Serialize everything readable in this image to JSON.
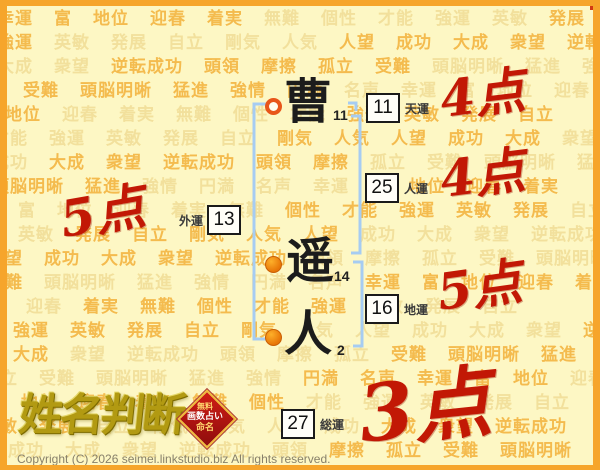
{
  "background": {
    "words": [
      "幸運",
      "富",
      "地位",
      "迎春",
      "着実",
      "無難",
      "個性",
      "才能",
      "強運",
      "英敏",
      "発展",
      "自立",
      "剛気",
      "人気",
      "人望",
      "成功",
      "大成",
      "衆望",
      "逆転成功",
      "頭領",
      "摩擦",
      "孤立",
      "受難",
      "頭脳明晰",
      "猛進",
      "強情",
      "円満",
      "名声"
    ]
  },
  "name": {
    "chars": [
      {
        "char": "曹",
        "strokes": "11"
      },
      {
        "char": "遥",
        "strokes": "14"
      },
      {
        "char": "人",
        "strokes": "2"
      }
    ]
  },
  "fortunes": [
    {
      "id": "ten",
      "label": "天運",
      "value": "11",
      "score": "4点"
    },
    {
      "id": "jin",
      "label": "人運",
      "value": "25",
      "score": "4点"
    },
    {
      "id": "gai",
      "label": "外運",
      "value": "13",
      "score": "5点"
    },
    {
      "id": "chi",
      "label": "地運",
      "value": "16",
      "score": "5点"
    },
    {
      "id": "sou",
      "label": "総運",
      "value": "27",
      "score": "3点"
    }
  ],
  "logo": {
    "title": "姓名判断",
    "badge_lines": [
      "無料",
      "画数占い",
      "命名"
    ]
  },
  "footer": {
    "copyright": "Copyright (C) 2026 seimei.linkstudio.biz All rights reserved."
  },
  "colors": {
    "border_orange": "#f6a52b",
    "background_yellow": "#fdf7c4",
    "word_strong": "#f4bb4e",
    "word_faint": "#f2e09c",
    "bracket_blue": "#a6ccf2",
    "score_red": "#c21805",
    "logo_gold": "#b29a12",
    "badge_red": "#b01111"
  }
}
